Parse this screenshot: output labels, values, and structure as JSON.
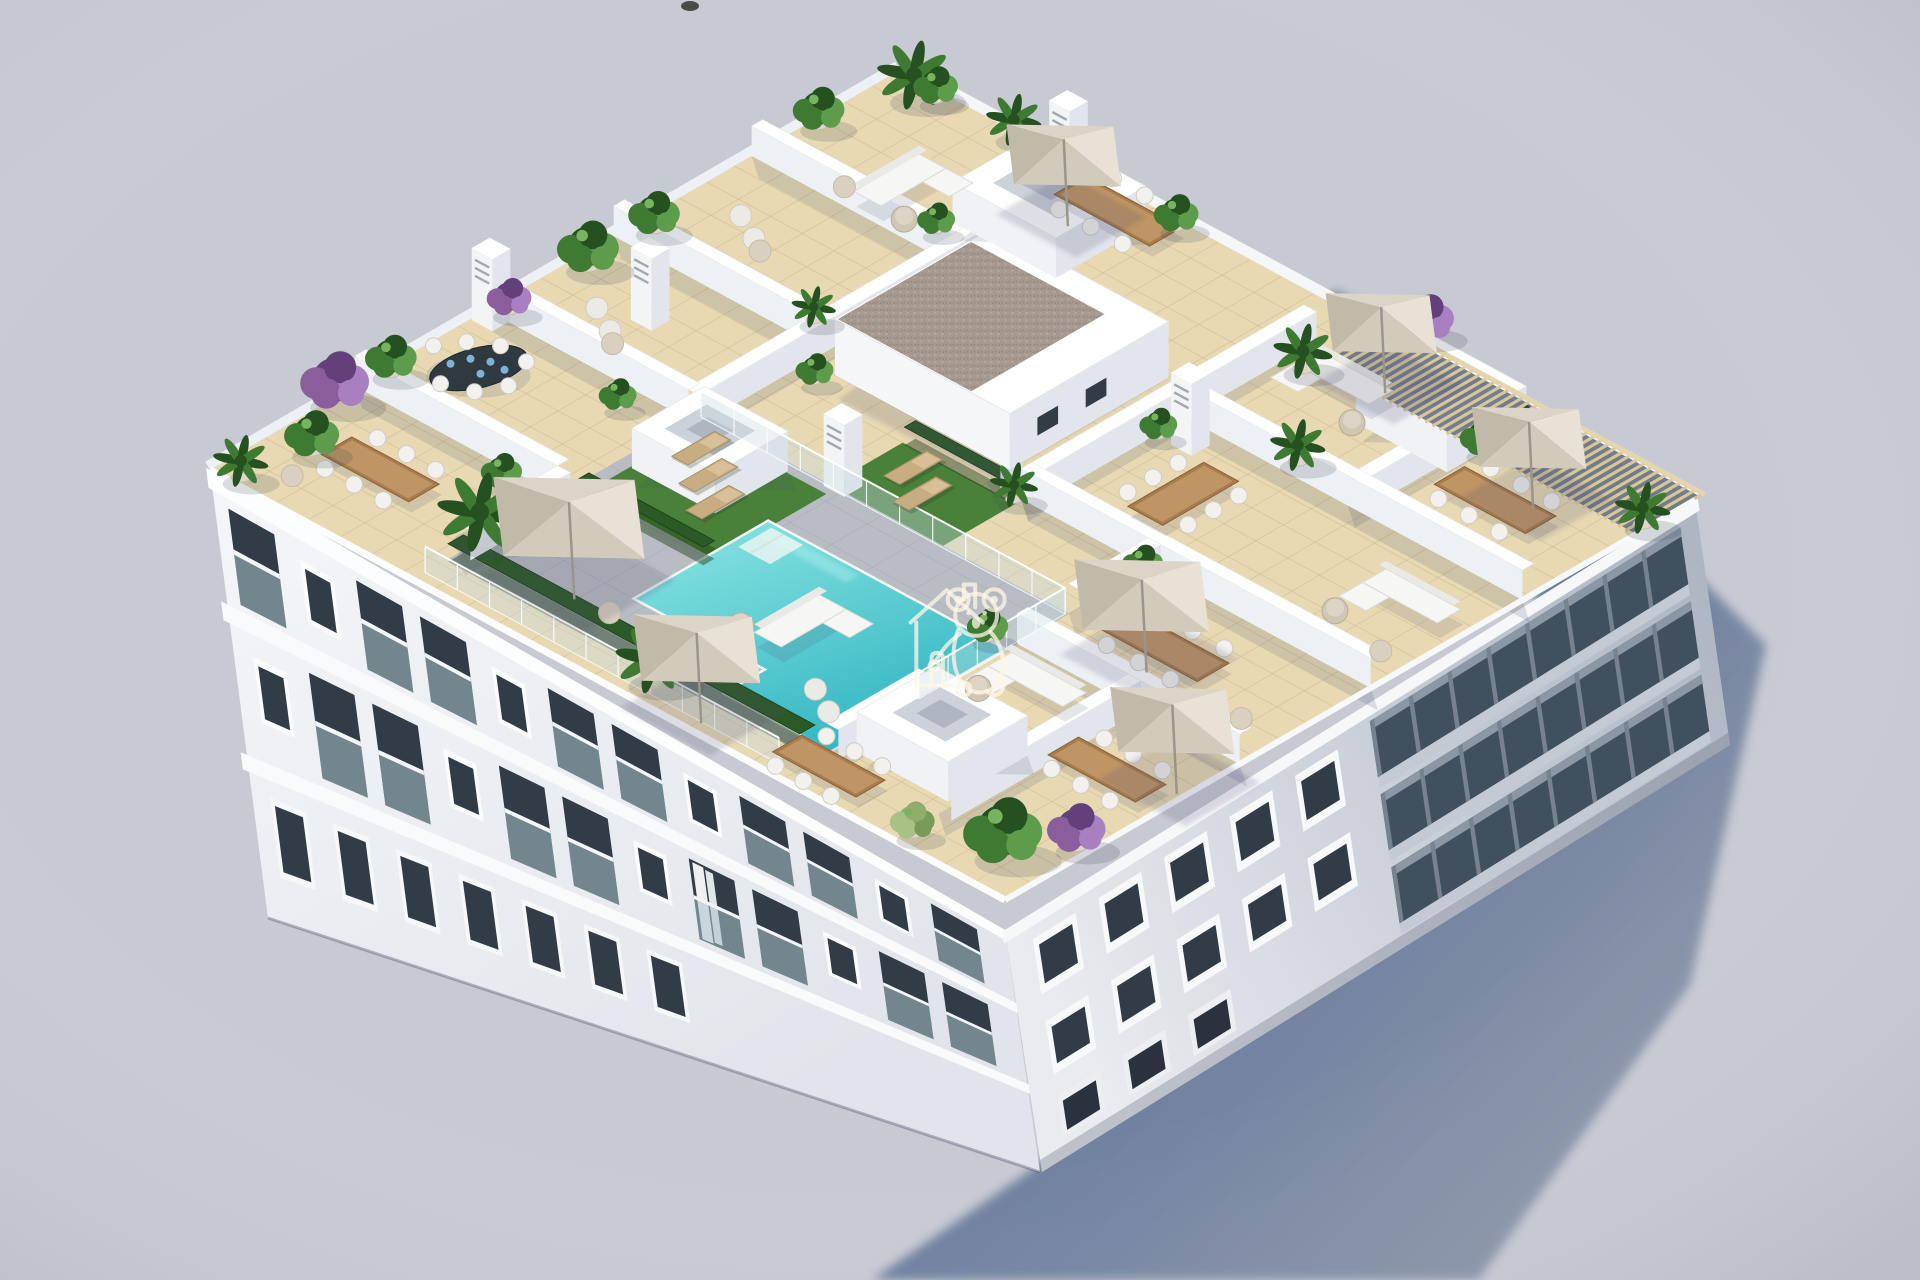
{
  "meta": {
    "title": "Aerial 3D architectural render",
    "type": "architectural-visualization",
    "view": "isometric aerial view from above",
    "description": "Aerial isometric 3D rendering of a white apartment building rooftop with private beige-tiled terraces divided by white walls, an L-shaped turquoise swimming pool with glass fencing and artificial-grass sun decks, beige parasols, wooden dining sets, white sofas, palms and purple bougainvillea; long blue-grey shadow cast on a pale ground; white koala-and-house watermark in the centre."
  },
  "watermark": {
    "name": "koala-house-logo",
    "style": "white outline line-art of a koala hugging a small house",
    "opacity": 0.75,
    "color": "#fff7e6"
  },
  "scene": {
    "features": [
      "L-shaped turquoise swimming pool",
      "glass pool fence",
      "artificial grass sun decks with wooden loungers",
      "beige cantilever parasols",
      "private rooftop terraces with white dividing walls",
      "wooden dining tables with white chairs",
      "dark oval dining table with blue place settings",
      "white outdoor corner sofas and round poufs",
      "potted palms, shrubs and purple bougainvillea",
      "white skylight and stair boxes",
      "louvered chimney pillars",
      "gravel-topped penthouse roof",
      "timber slat pergola along the east roof edge",
      "white facades with recessed balconies and dark windows",
      "long cast shadow on pale grey ground"
    ],
    "counts": {
      "parasols": 7,
      "skylight_boxes": 4,
      "chimneys": 5,
      "pools": 1
    }
  },
  "colors": {
    "background": "#c7cad2",
    "shadow_near": "#4e6590",
    "shadow_far": "#8c96a9",
    "wall_top": "#ffffff",
    "wall_sw": "#edf0f4",
    "wall_se": "#e2e6ec",
    "facade_light": "#f3f5f8",
    "facade_low": "#e1e5eb",
    "facade_se_near": "#e8ebef",
    "facade_se_far": "#aeb6c3",
    "window_dark": "#323c46",
    "glass_balcony": "#41505e",
    "glass_rail": "#a9c2c9",
    "tile": "#e8d9b3",
    "tile_line": "#c9b48b",
    "deck": "#b9bdc3",
    "deck_line": "#a6aab1",
    "pool_light": "#7fdede",
    "pool_deep": "#2fb4c2",
    "grass": "#49813a",
    "grass_dark": "#36652a",
    "hedge": "#2c5a26",
    "wood": "#a87c4f",
    "wood_light": "#bf9563",
    "chair": "#f2f1ed",
    "parasol_ne": "#e8e2d6",
    "parasol_se": "#d2cabb",
    "parasol_sw": "#c2baa9",
    "parasol_nw": "#dcd5c7",
    "pergola_slat": "#d6c79d",
    "pergola_dark": "#667080",
    "gravel": "#a69a90",
    "plant_dark": "#24511f",
    "plant_mid": "#3f7a33",
    "plant_light": "#5d9c4a",
    "purple": "#8a5d9d",
    "purple_dark": "#64407a",
    "pot": "#ddd7cb"
  }
}
